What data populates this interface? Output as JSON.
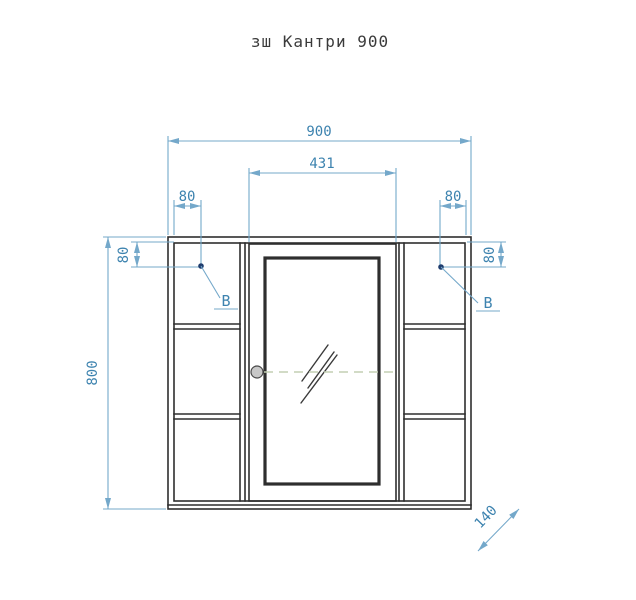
{
  "page": {
    "title": "зш Кантри 900"
  },
  "drawing": {
    "type": "front-elevation-technical-drawing",
    "dimensions": {
      "overall_width": "900",
      "door_width": "431",
      "top_offset_left": "80",
      "top_offset_right": "80",
      "side_offset_left": "80",
      "side_offset_right": "80",
      "overall_height": "800",
      "depth": "140"
    },
    "markers": {
      "left": "B",
      "right": "B"
    }
  },
  "colors": {
    "page-bg": "#ffffff",
    "drawing-line": "#2e2e2e",
    "dim-line": "#74a8ca",
    "dim-text": "#3d83af",
    "leader-dot": "#1f3d6e",
    "center-dash": "#c4cfb3",
    "handle-fill": "#c8c8c8",
    "title-text": "#3a3a3a"
  }
}
